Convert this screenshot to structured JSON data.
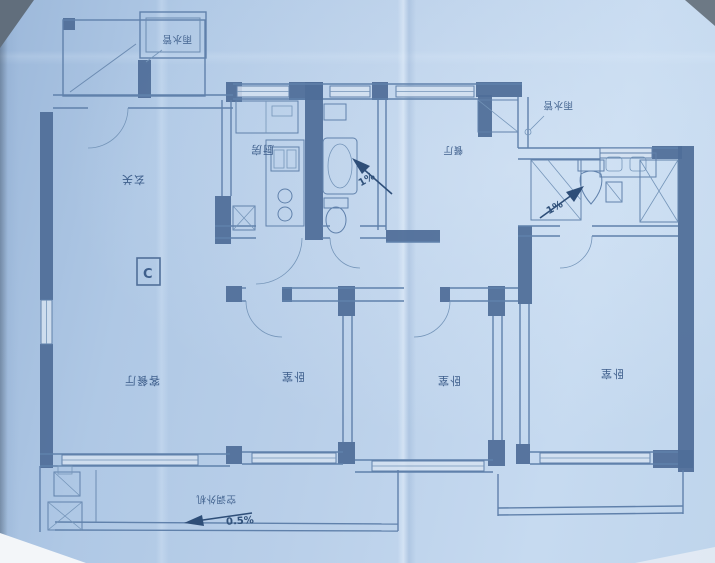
{
  "labels": {
    "rain_pipe_left": "雨水管",
    "rain_pipe_right": "雨水管",
    "kitchen": "厨房",
    "entry": "玄关",
    "unit_marker": "C",
    "living_dining": "客餐厅",
    "dining": "餐厅",
    "bedroom_left": "卧室",
    "bedroom_mid": "卧室",
    "bedroom_right": "卧室",
    "bath_slope_left": "1%",
    "bath_slope_right": "1%",
    "balcony_slope": "0.5%",
    "ac_outdoor_unit": "空调外机"
  },
  "colors": {
    "paper": "#b9cfe9",
    "ink": "#5d81af",
    "wall_fill": "#4e6f9d",
    "text": "#3c5f90",
    "arrow": "#2c4e7c"
  }
}
